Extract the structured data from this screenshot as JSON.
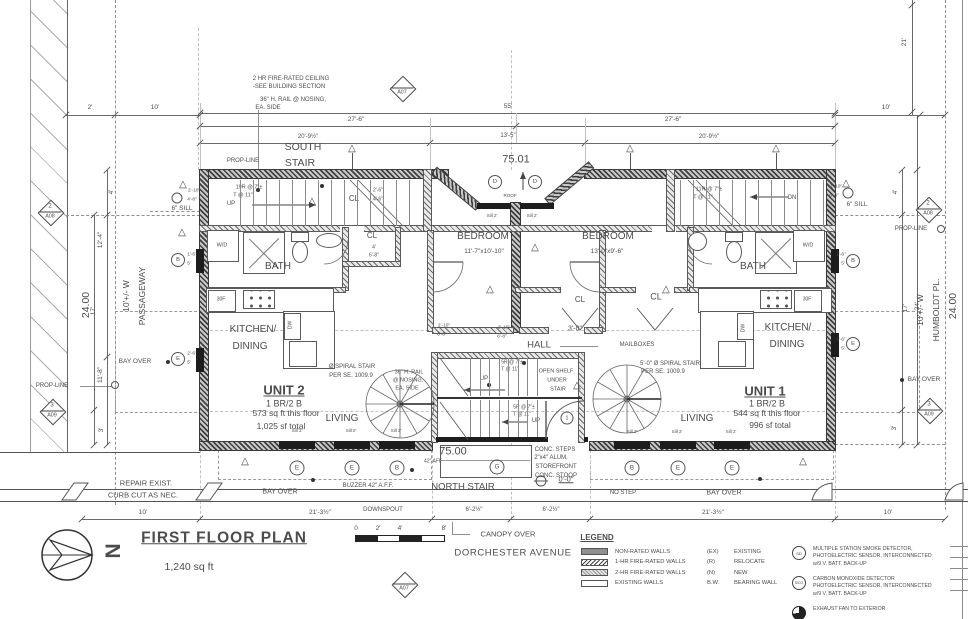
{
  "drawing": {
    "title": "FIRST FLOOR PLAN",
    "area": "1,240 sq ft",
    "street": "DORCHESTER AVENUE",
    "north": "N"
  },
  "scale_bar": {
    "labels": [
      "0",
      "2'",
      "4'",
      "8'"
    ]
  },
  "legend": {
    "heading": "LEGEND",
    "wall_types": [
      {
        "swatch": "solid",
        "label": "NON-RATED WALLS"
      },
      {
        "swatch": "hatch1",
        "label": "1-HR FIRE-RATED WALLS"
      },
      {
        "swatch": "hatch2",
        "label": "2-HR FIRE-RATED WALLS"
      },
      {
        "swatch": "existing",
        "label": "EXISTING WALLS"
      }
    ],
    "abbreviations": [
      {
        "key": "(EX)",
        "label": "EXISTING"
      },
      {
        "key": "(R)",
        "label": "RELOCATE"
      },
      {
        "key": "(N)",
        "label": "NEW"
      },
      {
        "key": "B.W.",
        "label": "BEARING WALL"
      }
    ]
  },
  "notes": [
    {
      "symbol": "circle-sd",
      "sym_text": "SD",
      "lines": [
        "MULTIPLE STATION SMOKE DETECTOR,",
        "PHOTOELECTRIC SENSOR, INTERCONNECTED",
        "w/9 V. BATT. BACK-UP"
      ]
    },
    {
      "symbol": "circle-sco",
      "sym_text": "S/CO",
      "lines": [
        "CARBON MONOXIDE DETECTOR",
        "PHOTOELECTRIC SENSOR, INTERCONNECTED",
        "w/9 V. BATT. BACK-UP"
      ]
    },
    {
      "symbol": "fan",
      "sym_text": "",
      "lines": [
        "EXHAUST FAN TO EXTERIOR"
      ]
    }
  ],
  "labels": [
    {
      "t": "2 HR FIRE-RATED CEILING",
      "x": 291,
      "y": 79,
      "s": 6
    },
    {
      "t": "-SEE BUILDING SECTION",
      "x": 289,
      "y": 87,
      "s": 6
    },
    {
      "t": "36\" H. RAIL @ NOSING,",
      "x": 293,
      "y": 100,
      "s": 6
    },
    {
      "t": "EA. SIDE",
      "x": 268,
      "y": 108,
      "s": 6
    },
    {
      "t": "SOUTH",
      "x": 303,
      "y": 147,
      "s": 10.5
    },
    {
      "t": "STAIR",
      "x": 300,
      "y": 163,
      "s": 10.5
    },
    {
      "t": "PROP-LINE",
      "x": 243,
      "y": 161,
      "s": 6
    },
    {
      "t": "PROP-LINE",
      "x": 52,
      "y": 386,
      "s": 6
    },
    {
      "t": "PROP-LINE",
      "x": 911,
      "y": 229,
      "s": 6
    },
    {
      "t": "19R @ 7\"±",
      "x": 249,
      "y": 188,
      "s": 5.5
    },
    {
      "t": "T @ 11\"",
      "x": 243,
      "y": 196,
      "s": 5.5
    },
    {
      "t": "UP",
      "x": 231,
      "y": 204,
      "s": 6
    },
    {
      "t": "11R @ 7\"±",
      "x": 709,
      "y": 190,
      "s": 5.5
    },
    {
      "t": "T @ 11\"",
      "x": 703,
      "y": 198,
      "s": 5.5
    },
    {
      "t": "DN",
      "x": 792,
      "y": 198,
      "s": 6
    },
    {
      "t": "6\" SILL",
      "x": 182,
      "y": 209,
      "s": 6.5
    },
    {
      "t": "6\" SILL",
      "x": 857,
      "y": 205,
      "s": 6.5
    },
    {
      "t": "W/D",
      "x": 222,
      "y": 246,
      "s": 5.5
    },
    {
      "t": "W/D",
      "x": 808,
      "y": 246,
      "s": 5.5
    },
    {
      "t": "BATH",
      "x": 278,
      "y": 267,
      "s": 10
    },
    {
      "t": "BATH",
      "x": 753,
      "y": 267,
      "s": 10
    },
    {
      "t": "CL",
      "x": 354,
      "y": 199,
      "s": 8
    },
    {
      "t": "2'-6\"",
      "x": 378,
      "y": 191,
      "s": 5
    },
    {
      "t": "4'-6\"",
      "x": 378,
      "y": 200,
      "s": 5
    },
    {
      "t": "CL",
      "x": 372,
      "y": 236,
      "s": 8
    },
    {
      "t": "4'",
      "x": 374,
      "y": 248,
      "s": 5
    },
    {
      "t": "6'-8\"",
      "x": 374,
      "y": 256,
      "s": 5
    },
    {
      "t": "BEDROOM",
      "x": 483,
      "y": 237,
      "s": 10
    },
    {
      "t": "11'-7\"x10'-10\"",
      "x": 484,
      "y": 252,
      "s": 6.5
    },
    {
      "t": "BEDROOM",
      "x": 608,
      "y": 237,
      "s": 10
    },
    {
      "t": "13'-0\"x9'-6\"",
      "x": 607,
      "y": 252,
      "s": 6.5
    },
    {
      "t": "CL",
      "x": 580,
      "y": 300,
      "s": 8
    },
    {
      "t": "CL",
      "x": 656,
      "y": 297,
      "s": 9
    },
    {
      "t": "KITCHEN/",
      "x": 253,
      "y": 330,
      "s": 10
    },
    {
      "t": "DINING",
      "x": 250,
      "y": 347,
      "s": 10
    },
    {
      "t": "KITCHEN/",
      "x": 788,
      "y": 328,
      "s": 10
    },
    {
      "t": "DINING",
      "x": 787,
      "y": 345,
      "s": 10
    },
    {
      "t": "30F",
      "x": 221,
      "y": 300,
      "s": 5
    },
    {
      "t": "30F",
      "x": 807,
      "y": 300,
      "s": 5
    },
    {
      "t": "DW",
      "x": 291,
      "y": 325,
      "s": 5,
      "r": -90
    },
    {
      "t": "DW",
      "x": 744,
      "y": 328,
      "s": 5,
      "r": -90
    },
    {
      "t": "HALL",
      "x": 539,
      "y": 345,
      "s": 9.5
    },
    {
      "t": "3'-0\"",
      "x": 575,
      "y": 329,
      "s": 7
    },
    {
      "t": "MAILBOXES",
      "x": 637,
      "y": 345,
      "s": 6
    },
    {
      "t": "OPEN SHELF",
      "x": 556,
      "y": 372,
      "s": 5.5
    },
    {
      "t": "UNDER",
      "x": 557,
      "y": 381,
      "s": 5.5
    },
    {
      "t": "STAIR",
      "x": 558,
      "y": 390,
      "s": 5.5
    },
    {
      "t": "5R @ 7\"±",
      "x": 512,
      "y": 363,
      "s": 5
    },
    {
      "t": "T @ 11\"",
      "x": 510,
      "y": 370,
      "s": 5
    },
    {
      "t": "5R @ 7\"±",
      "x": 524,
      "y": 408,
      "s": 5
    },
    {
      "t": "T @ 11\"",
      "x": 522,
      "y": 415,
      "s": 5
    },
    {
      "t": "UP",
      "x": 484,
      "y": 379,
      "s": 6
    },
    {
      "t": "UP",
      "x": 536,
      "y": 421,
      "s": 6
    },
    {
      "t": "Ø SPIRAL STAIR",
      "x": 352,
      "y": 367,
      "s": 6
    },
    {
      "t": "PER SE. 1009.9",
      "x": 351,
      "y": 376,
      "s": 6
    },
    {
      "t": "36\" H. RAIL",
      "x": 409,
      "y": 373,
      "s": 5.5
    },
    {
      "t": "@ NOSING,",
      "x": 408,
      "y": 381,
      "s": 5.5
    },
    {
      "t": "EA. SIDE",
      "x": 407,
      "y": 389,
      "s": 5.5
    },
    {
      "t": "5'-0\" Ø SPIRAL STAIR",
      "x": 670,
      "y": 364,
      "s": 6
    },
    {
      "t": "PER SE. 1009.9",
      "x": 663,
      "y": 372,
      "s": 6
    },
    {
      "t": "UNIT 2",
      "x": 284,
      "y": 390,
      "s": 13,
      "w": 1,
      "u": 1
    },
    {
      "t": "1 BR/2 B",
      "x": 284,
      "y": 404,
      "s": 9
    },
    {
      "t": "573 sq ft this floor",
      "x": 286,
      "y": 413,
      "s": 8.5
    },
    {
      "t": "1,025 sf total",
      "x": 281,
      "y": 426,
      "s": 8.5
    },
    {
      "t": "UNIT 1",
      "x": 765,
      "y": 391,
      "s": 13,
      "w": 1,
      "u": 1
    },
    {
      "t": "1 BR/2 B",
      "x": 767,
      "y": 404,
      "s": 9
    },
    {
      "t": "544 sq ft this floor",
      "x": 767,
      "y": 413,
      "s": 8.5
    },
    {
      "t": "996 sf total",
      "x": 770,
      "y": 425,
      "s": 8.5
    },
    {
      "t": "LIVING",
      "x": 342,
      "y": 419,
      "s": 10
    },
    {
      "t": "LIVING",
      "x": 697,
      "y": 419,
      "s": 10
    },
    {
      "t": "Sill 2'",
      "x": 297,
      "y": 431,
      "s": 4.5
    },
    {
      "t": "Sill 2'",
      "x": 351,
      "y": 431,
      "s": 4.5
    },
    {
      "t": "Sill 2'",
      "x": 396,
      "y": 431,
      "s": 4.5
    },
    {
      "t": "Sill 2'",
      "x": 632,
      "y": 432,
      "s": 4.5
    },
    {
      "t": "Sill 2'",
      "x": 677,
      "y": 432,
      "s": 4.5
    },
    {
      "t": "Sill 2'",
      "x": 731,
      "y": 432,
      "s": 4.5
    },
    {
      "t": "Sill 2'",
      "x": 492,
      "y": 216,
      "s": 4.5
    },
    {
      "t": "Sill 2'",
      "x": 532,
      "y": 216,
      "s": 4.5
    },
    {
      "t": "ROOF",
      "x": 510,
      "y": 196,
      "s": 4.5
    },
    {
      "t": "75.01",
      "x": 516,
      "y": 160,
      "s": 11
    },
    {
      "t": "75.00",
      "x": 453,
      "y": 452,
      "s": 11
    },
    {
      "t": "42\" AFF",
      "x": 433,
      "y": 462,
      "s": 5
    },
    {
      "t": "NORTH STAIR",
      "x": 463,
      "y": 487,
      "s": 9.5
    },
    {
      "t": "CONC. STEPS",
      "x": 555,
      "y": 450,
      "s": 6
    },
    {
      "t": "2\"x4\" ALUM.",
      "x": 551,
      "y": 458,
      "s": 6
    },
    {
      "t": "STOREFRONT",
      "x": 556,
      "y": 467,
      "s": 6
    },
    {
      "t": "CONC. STOOP",
      "x": 556,
      "y": 476,
      "s": 6
    },
    {
      "t": "0'-0\"",
      "x": 566,
      "y": 479,
      "s": 7.5,
      "u": 1
    },
    {
      "t": "NO STEP",
      "x": 623,
      "y": 493,
      "s": 6
    },
    {
      "t": "BUZZER 42\" A.F.F.",
      "x": 368,
      "y": 486,
      "s": 6
    },
    {
      "t": "BAY OVER",
      "x": 280,
      "y": 492,
      "s": 7
    },
    {
      "t": "BAY OVER",
      "x": 724,
      "y": 493,
      "s": 7
    },
    {
      "t": "BAY OVER",
      "x": 135,
      "y": 362,
      "s": 6.5
    },
    {
      "t": "BAY OVER",
      "x": 924,
      "y": 380,
      "s": 6.5
    },
    {
      "t": "DOWNSPOUT",
      "x": 383,
      "y": 510,
      "s": 6
    },
    {
      "t": "CANOPY OVER",
      "x": 508,
      "y": 534,
      "s": 7.5
    },
    {
      "t": "REPAIR EXIST.",
      "x": 146,
      "y": 483,
      "s": 7.5
    },
    {
      "t": "CURB CUT AS NEC.",
      "x": 143,
      "y": 495,
      "s": 7.5
    },
    {
      "t": "2'",
      "x": 90,
      "y": 108,
      "s": 6.5
    },
    {
      "t": "10'",
      "x": 155,
      "y": 108,
      "s": 6.5
    },
    {
      "t": "55'",
      "x": 508,
      "y": 107,
      "s": 6.5
    },
    {
      "t": "27'-6\"",
      "x": 356,
      "y": 120,
      "s": 6.5
    },
    {
      "t": "27'-6\"",
      "x": 673,
      "y": 120,
      "s": 6.5
    },
    {
      "t": "20'-9½\"",
      "x": 308,
      "y": 137,
      "s": 6
    },
    {
      "t": "13'-5\"",
      "x": 508,
      "y": 136,
      "s": 6
    },
    {
      "t": "20'-9½\"",
      "x": 709,
      "y": 137,
      "s": 6
    },
    {
      "t": "10'",
      "x": 886,
      "y": 108,
      "s": 6.5
    },
    {
      "t": "21'",
      "x": 905,
      "y": 42,
      "s": 6.5,
      "r": -90
    },
    {
      "t": "4'",
      "x": 896,
      "y": 192,
      "s": 6.5,
      "r": -90
    },
    {
      "t": "17'",
      "x": 906,
      "y": 308,
      "s": 6.5,
      "r": -90
    },
    {
      "t": "24'",
      "x": 918,
      "y": 306,
      "s": 6.5,
      "r": -90
    },
    {
      "t": "3'",
      "x": 895,
      "y": 428,
      "s": 6.5,
      "r": -90
    },
    {
      "t": "4'",
      "x": 112,
      "y": 192,
      "s": 6.5,
      "r": -90
    },
    {
      "t": "12'-4\"",
      "x": 101,
      "y": 240,
      "s": 6.5,
      "r": -90
    },
    {
      "t": "17'",
      "x": 94,
      "y": 311,
      "s": 6.5,
      "r": -90
    },
    {
      "t": "11'-8\"",
      "x": 101,
      "y": 375,
      "s": 6.5,
      "r": -90
    },
    {
      "t": "3'",
      "x": 102,
      "y": 430,
      "s": 6.5,
      "r": -90
    },
    {
      "t": "24.00",
      "x": 86,
      "y": 305,
      "s": 10.5,
      "r": -90
    },
    {
      "t": "24.00",
      "x": 953,
      "y": 306,
      "s": 10.5,
      "r": -90
    },
    {
      "t": "10'+/- W",
      "x": 126,
      "y": 296,
      "s": 8.5,
      "r": -90
    },
    {
      "t": "PASSAGEWAY",
      "x": 142,
      "y": 296,
      "s": 8.5,
      "r": -90
    },
    {
      "t": "10'+/- W",
      "x": 920,
      "y": 310,
      "s": 8.5,
      "r": -90
    },
    {
      "t": "HUMBOLDT PL.",
      "x": 936,
      "y": 310,
      "s": 8.5,
      "r": -90
    },
    {
      "t": "10'",
      "x": 143,
      "y": 513,
      "s": 6.5
    },
    {
      "t": "21'-3½\"",
      "x": 320,
      "y": 513,
      "s": 6.5
    },
    {
      "t": "6'-2½\"",
      "x": 474,
      "y": 510,
      "s": 6
    },
    {
      "t": "6'-2½\"",
      "x": 551,
      "y": 510,
      "s": 6
    },
    {
      "t": "21'-3½\"",
      "x": 713,
      "y": 513,
      "s": 6.5
    },
    {
      "t": "10'",
      "x": 888,
      "y": 513,
      "s": 6.5
    },
    {
      "t": "2'-10\"",
      "x": 194,
      "y": 192,
      "s": 4.8
    },
    {
      "t": "4'-8\"",
      "x": 192,
      "y": 201,
      "s": 4.8
    },
    {
      "t": "2'-10\"",
      "x": 836,
      "y": 188,
      "s": 4.8
    },
    {
      "t": "6'-4\"",
      "x": 834,
      "y": 197,
      "s": 4.8
    },
    {
      "t": "1'-6\"",
      "x": 192,
      "y": 256,
      "s": 4.8
    },
    {
      "t": "5'",
      "x": 189,
      "y": 265,
      "s": 4.8
    },
    {
      "t": "2'-6\"",
      "x": 192,
      "y": 355,
      "s": 4.8
    },
    {
      "t": "5'",
      "x": 189,
      "y": 364,
      "s": 4.8
    },
    {
      "t": "1'-6\"",
      "x": 841,
      "y": 256,
      "s": 4.8
    },
    {
      "t": "5'",
      "x": 843,
      "y": 265,
      "s": 4.8
    },
    {
      "t": "2'-6\"",
      "x": 841,
      "y": 341,
      "s": 4.8
    },
    {
      "t": "5'",
      "x": 843,
      "y": 350,
      "s": 4.8
    },
    {
      "t": "2'-10\"",
      "x": 444,
      "y": 327,
      "s": 4.8
    },
    {
      "t": "6'-8\"",
      "x": 442,
      "y": 336,
      "s": 4.8
    },
    {
      "t": "2'-10\"",
      "x": 504,
      "y": 329,
      "s": 4.8
    },
    {
      "t": "6'-8\"",
      "x": 502,
      "y": 338,
      "s": 4.8
    },
    {
      "t": "0",
      "x": 356,
      "y": 529,
      "s": 6.5
    },
    {
      "t": "2'",
      "x": 378,
      "y": 529,
      "s": 6.5
    },
    {
      "t": "4'",
      "x": 400,
      "y": 529,
      "s": 6.5
    },
    {
      "t": "8'",
      "x": 444,
      "y": 529,
      "s": 6.5
    },
    {
      "t": "N",
      "x": 112,
      "y": 551,
      "s": 21,
      "w": 1,
      "r": 90
    }
  ],
  "letter_markers": [
    {
      "t": "E",
      "x": 297,
      "y": 468,
      "d": 13
    },
    {
      "t": "E",
      "x": 352,
      "y": 468,
      "d": 13
    },
    {
      "t": "B",
      "x": 397,
      "y": 468,
      "d": 13
    },
    {
      "t": "G",
      "x": 497,
      "y": 467,
      "d": 13
    },
    {
      "t": "B",
      "x": 632,
      "y": 468,
      "d": 13
    },
    {
      "t": "E",
      "x": 678,
      "y": 468,
      "d": 13
    },
    {
      "t": "E",
      "x": 732,
      "y": 468,
      "d": 13
    },
    {
      "t": "B",
      "x": 178,
      "y": 260,
      "d": 12
    },
    {
      "t": "E",
      "x": 178,
      "y": 359,
      "d": 12
    },
    {
      "t": "B",
      "x": 853,
      "y": 261,
      "d": 12
    },
    {
      "t": "E",
      "x": 853,
      "y": 344,
      "d": 12
    },
    {
      "t": "D",
      "x": 495,
      "y": 182,
      "d": 12
    },
    {
      "t": "D",
      "x": 535,
      "y": 182,
      "d": 12
    },
    {
      "t": "1",
      "x": 567,
      "y": 418,
      "d": 11
    },
    {
      "t": "",
      "x": 177,
      "y": 198,
      "d": 9
    },
    {
      "t": "",
      "x": 848,
      "y": 193,
      "d": 9
    },
    {
      "t": "",
      "x": 115,
      "y": 385,
      "d": 6
    },
    {
      "t": "",
      "x": 941,
      "y": 229,
      "d": 6
    }
  ],
  "section_markers": [
    {
      "num": "",
      "label": "A07",
      "x": 402,
      "y": 88
    },
    {
      "num": "",
      "label": "A07",
      "x": 404,
      "y": 584
    },
    {
      "num": "2",
      "label": "A08",
      "x": 50,
      "y": 212
    },
    {
      "num": "2",
      "label": "A08",
      "x": 928,
      "y": 209
    },
    {
      "num": "3",
      "label": "A09",
      "x": 52,
      "y": 411
    },
    {
      "num": "3",
      "label": "A09",
      "x": 929,
      "y": 410
    }
  ],
  "revision_triangles": [
    {
      "x": 183,
      "y": 185,
      "flag": false
    },
    {
      "x": 182,
      "y": 233,
      "flag": false
    },
    {
      "x": 312,
      "y": 202,
      "flag": false
    },
    {
      "x": 846,
      "y": 184,
      "flag": false
    },
    {
      "x": 535,
      "y": 248,
      "flag": false
    },
    {
      "x": 490,
      "y": 290,
      "flag": false
    },
    {
      "x": 666,
      "y": 290,
      "flag": false
    },
    {
      "x": 577,
      "y": 386,
      "flag": false
    },
    {
      "x": 245,
      "y": 462,
      "flag": false
    },
    {
      "x": 803,
      "y": 462,
      "flag": false
    },
    {
      "x": 352,
      "y": 149,
      "flag": true
    },
    {
      "x": 630,
      "y": 149,
      "flag": true
    },
    {
      "x": 776,
      "y": 149,
      "flag": true
    }
  ],
  "dots": [
    {
      "x": 168,
      "y": 362,
      "r": 2
    },
    {
      "x": 313,
      "y": 480,
      "r": 2
    },
    {
      "x": 760,
      "y": 479,
      "r": 2
    },
    {
      "x": 902,
      "y": 380,
      "r": 2
    },
    {
      "x": 258,
      "y": 190,
      "r": 2
    },
    {
      "x": 322,
      "y": 186,
      "r": 2
    },
    {
      "x": 524,
      "y": 363,
      "r": 2
    },
    {
      "x": 489,
      "y": 385,
      "r": 2
    },
    {
      "x": 412,
      "y": 470,
      "r": 2
    }
  ]
}
